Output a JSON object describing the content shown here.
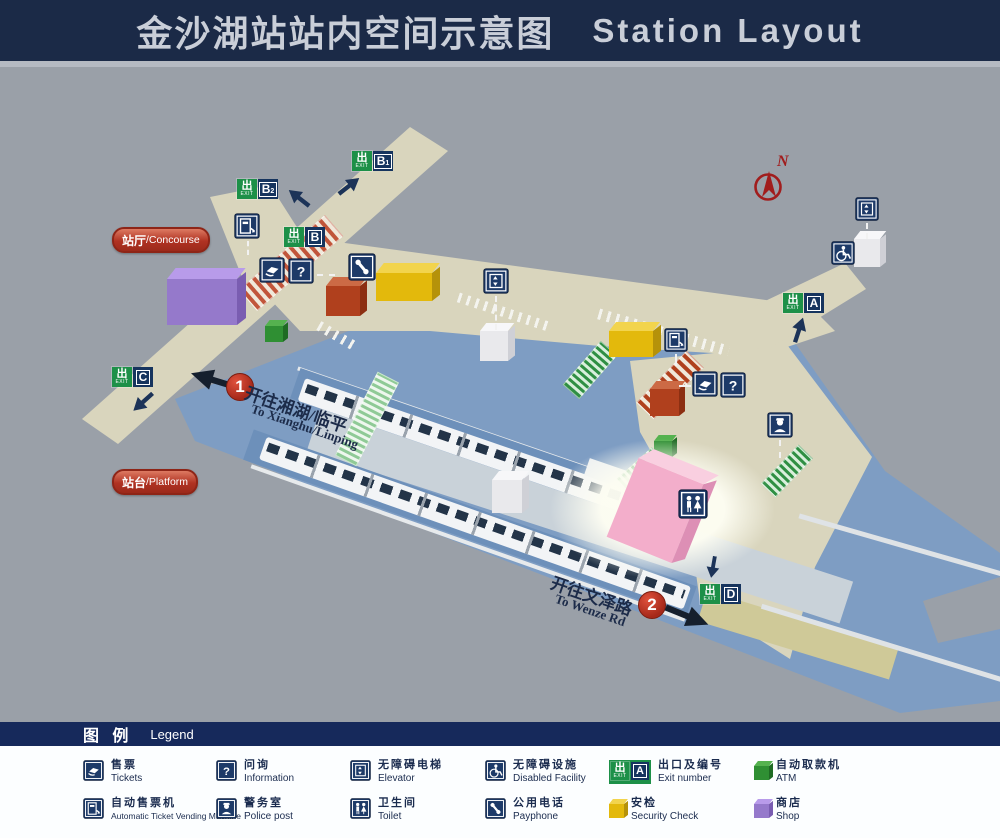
{
  "header": {
    "title_zh": "金沙湖站站内空间示意图",
    "title_en": "Station  Layout"
  },
  "map": {
    "compass": "N",
    "exit_word": "出",
    "exit_sub_word": "EXIT",
    "area_labels": {
      "concourse_zh": "站厅",
      "concourse_en": "/Concourse",
      "platform_zh": "站台",
      "platform_en": "/Platform"
    },
    "exits": [
      {
        "letter": "B",
        "sub": "1"
      },
      {
        "letter": "B",
        "sub": "2"
      },
      {
        "letter": "B",
        "sub": ""
      },
      {
        "letter": "C",
        "sub": ""
      },
      {
        "letter": "A",
        "sub": ""
      },
      {
        "letter": "D",
        "sub": ""
      }
    ],
    "directions": [
      {
        "num": "1",
        "zh": "开往湘湖/临平",
        "en": "To Xianghu/Linping"
      },
      {
        "num": "2",
        "zh": "开往文泽路",
        "en": "To Wenze Rd"
      }
    ]
  },
  "legend": {
    "title_zh": "图   例",
    "title_en": "Legend",
    "exit_letter": "A",
    "items": [
      {
        "zh": "售票",
        "en": "Tickets",
        "icon": "tickets-icon"
      },
      {
        "zh": "问询",
        "en": "Information",
        "icon": "information-icon"
      },
      {
        "zh": "无障碍电梯",
        "en": "Elevator",
        "icon": "elevator-icon"
      },
      {
        "zh": "无障碍设施",
        "en": "Disabled Facility",
        "icon": "disabled-facility-icon"
      },
      {
        "zh": "出口及编号",
        "en": "Exit number",
        "icon": "exit-number-icon"
      },
      {
        "zh": "自动取款机",
        "en": "ATM",
        "icon": "atm-cube-icon"
      },
      {
        "zh": "自动售票机",
        "en": "Automatic Ticket Vending Machine",
        "icon": "ticket-vending-machine-icon"
      },
      {
        "zh": "警务室",
        "en": "Police post",
        "icon": "police-post-icon"
      },
      {
        "zh": "卫生间",
        "en": "Toilet",
        "icon": "toilet-icon"
      },
      {
        "zh": "公用电话",
        "en": "Payphone",
        "icon": "payphone-icon"
      },
      {
        "zh": "安检",
        "en": "Security Check",
        "icon": "security-cube-icon"
      },
      {
        "zh": "商店",
        "en": "Shop",
        "icon": "shop-cube-icon"
      }
    ]
  },
  "colors": {
    "header_navy": "#1b2a47",
    "legend_navy": "#16295b",
    "icon_navy": "#1d3a68",
    "exit_green": "#1d9048",
    "map_gray": "#9aa0a8",
    "floor_beige": "#d9d5bd",
    "floor_blue": "#7e9dc3",
    "pill_red": "#b03222",
    "direction_circle_red": "#a5281a",
    "atm_green": "#2f8f33",
    "security_yellow": "#e3b90c",
    "shop_purple": "#9579cb",
    "toilet_pink": "#f3aecb",
    "compass_red": "#a11d1d"
  }
}
